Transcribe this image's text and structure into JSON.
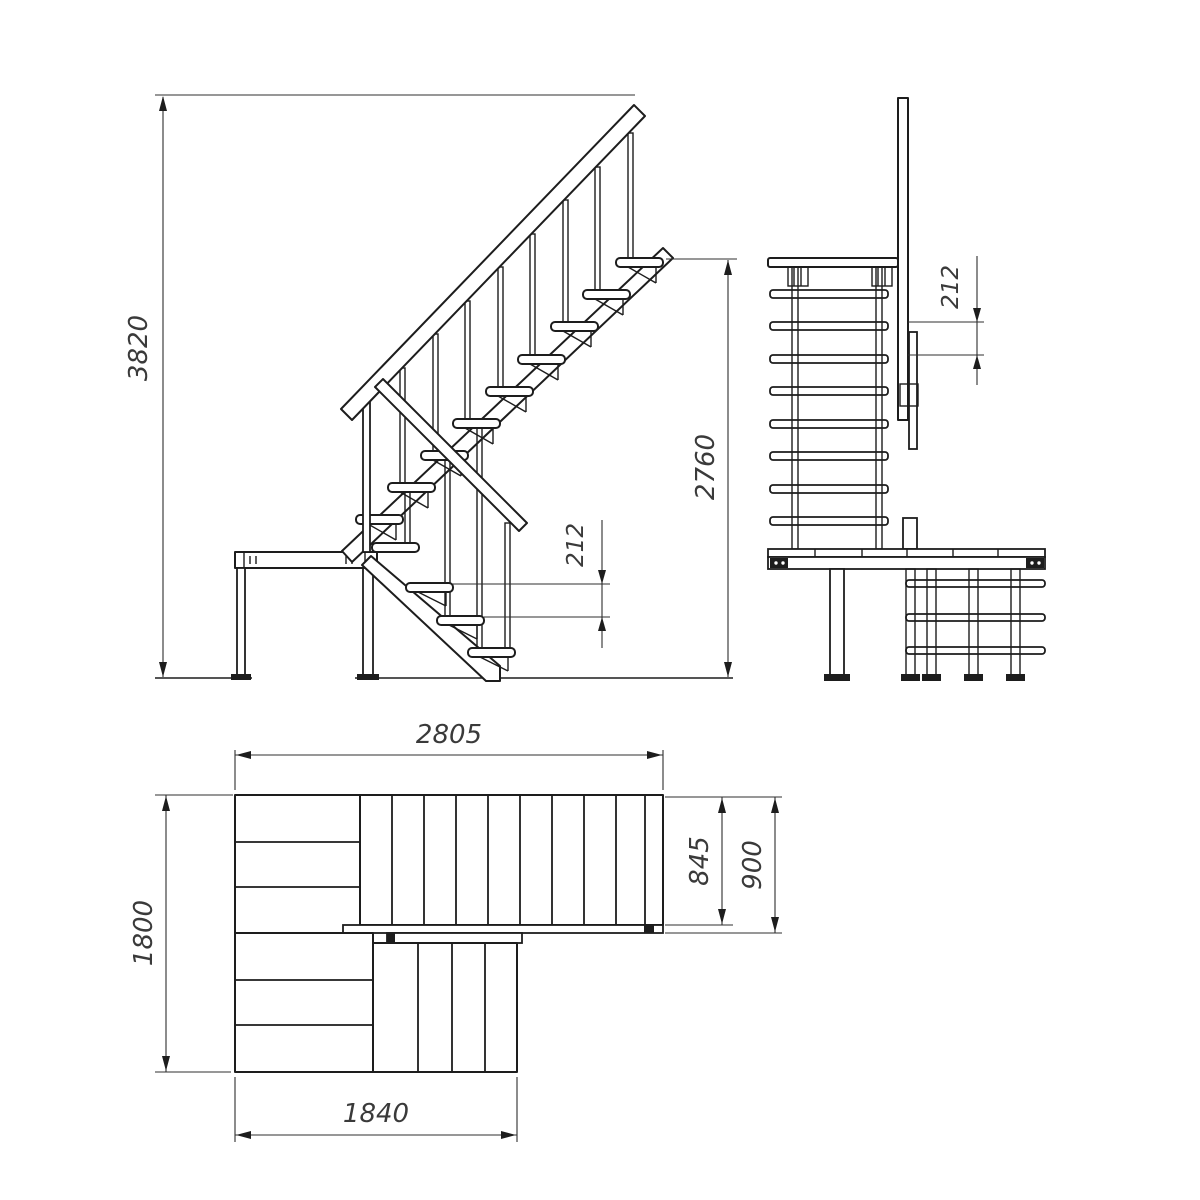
{
  "colors": {
    "background": "#ffffff",
    "line": "#1d1d1d",
    "dimension_line": "#2f2f2f",
    "dimension_text": "#3a3a3a"
  },
  "front_view": {
    "total_height": "3820",
    "upper_flight_height": "2760",
    "step_rise": "212"
  },
  "side_view": {
    "step_rise": "212"
  },
  "plan_view": {
    "upper_flight_length": "2805",
    "tread_width": "845",
    "flight_width": "900",
    "landing_depth": "1800",
    "lower_flight_length": "1840"
  }
}
